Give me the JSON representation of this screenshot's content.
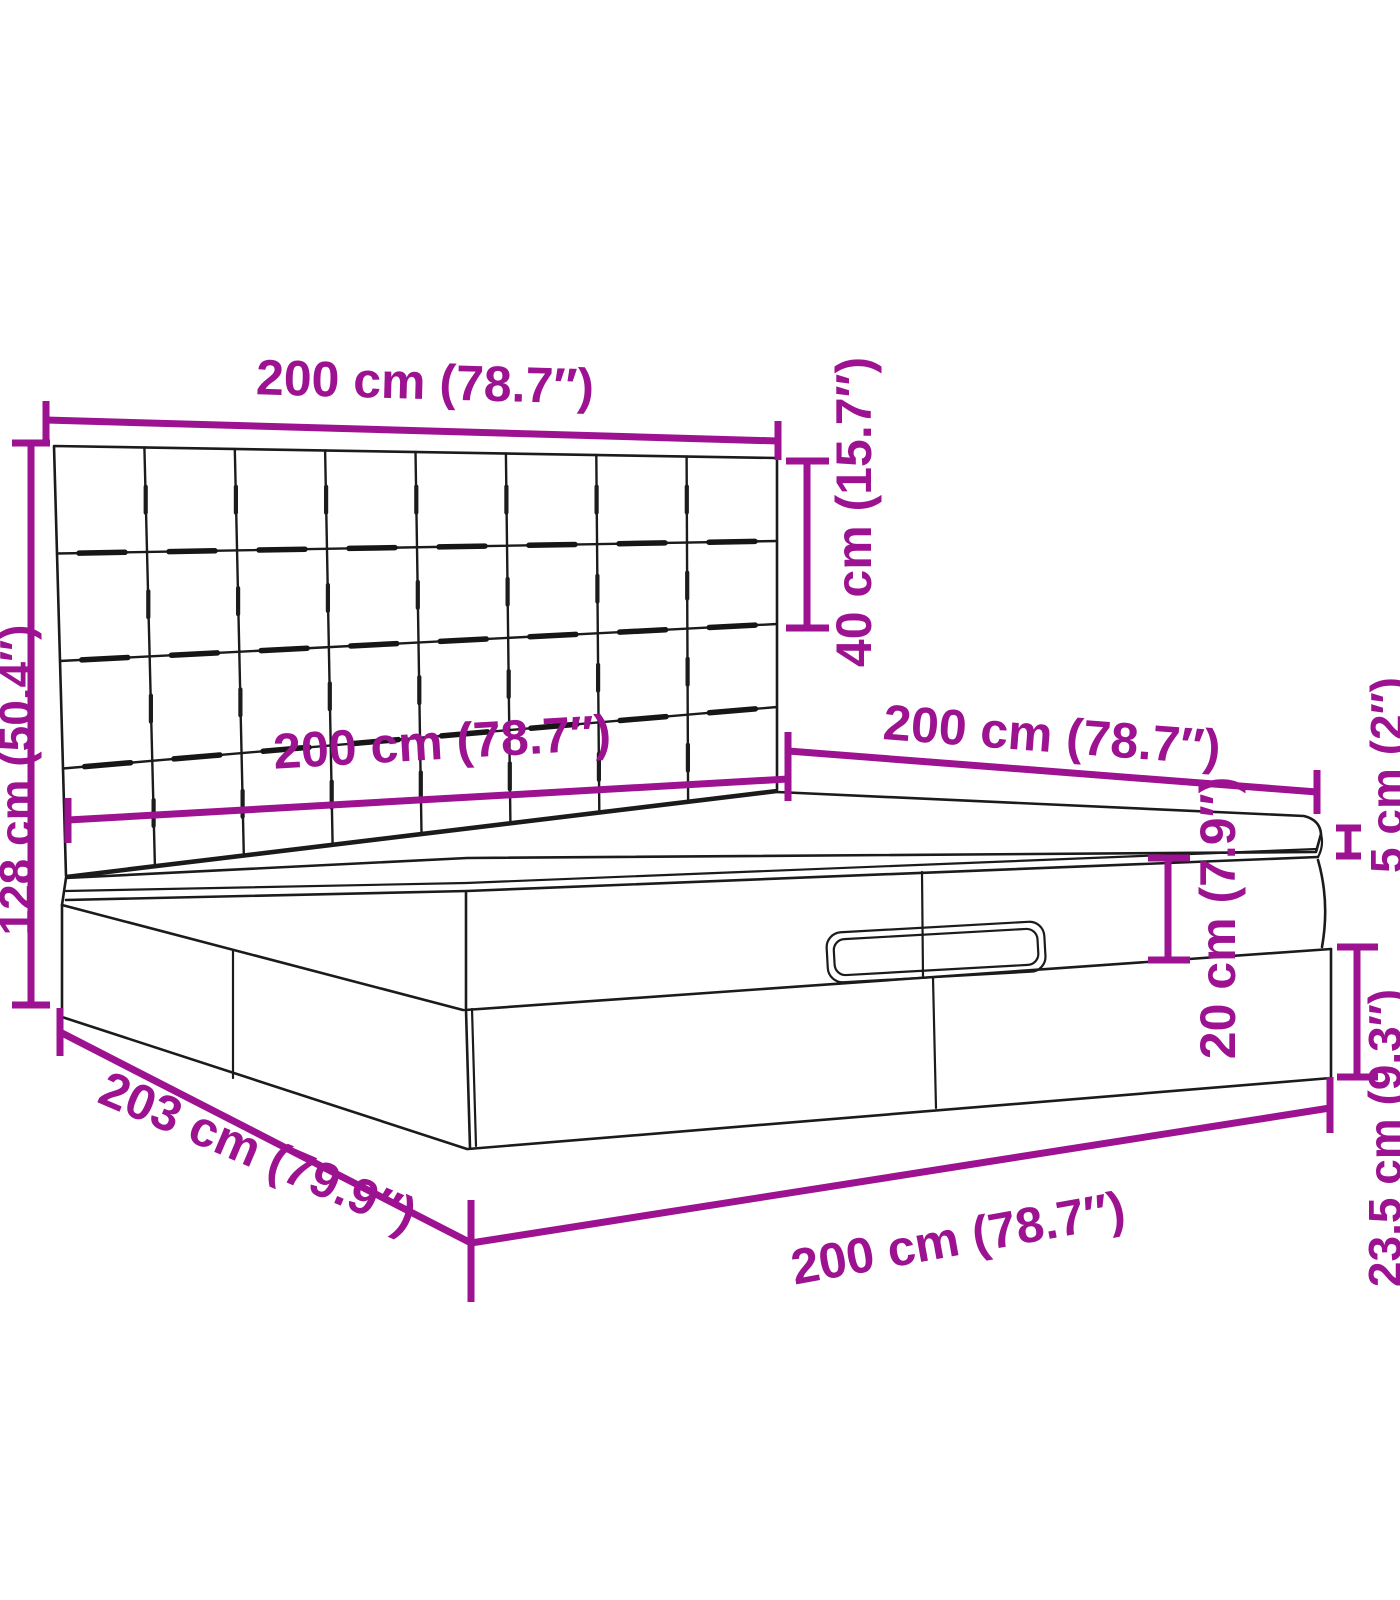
{
  "figure": {
    "type": "product-dimension-diagram",
    "subject": "ottoman storage bed with square-tufted headboard, mattress topper, lift-up upper box with handle and storage base",
    "colors": {
      "dimension_color": "#9C1290",
      "outline_color": "#1B1B1B",
      "background": "#FFFFFF"
    },
    "dimensions": {
      "headboard_width": "200 cm (78.7″)",
      "headboard_height": "40 cm (15.7″)",
      "overall_height": "128 cm (50.4″)",
      "mattress_width": "200 cm (78.7″)",
      "bed_depth": "200 cm (78.7″)",
      "topper_thickness": "5 cm (2″)",
      "upper_box_height": "20 cm (7.9″)",
      "base_height": "23.5 cm (9.3″)",
      "overall_length": "203 cm (79.9″)",
      "base_width": "200 cm (78.7″)"
    }
  }
}
